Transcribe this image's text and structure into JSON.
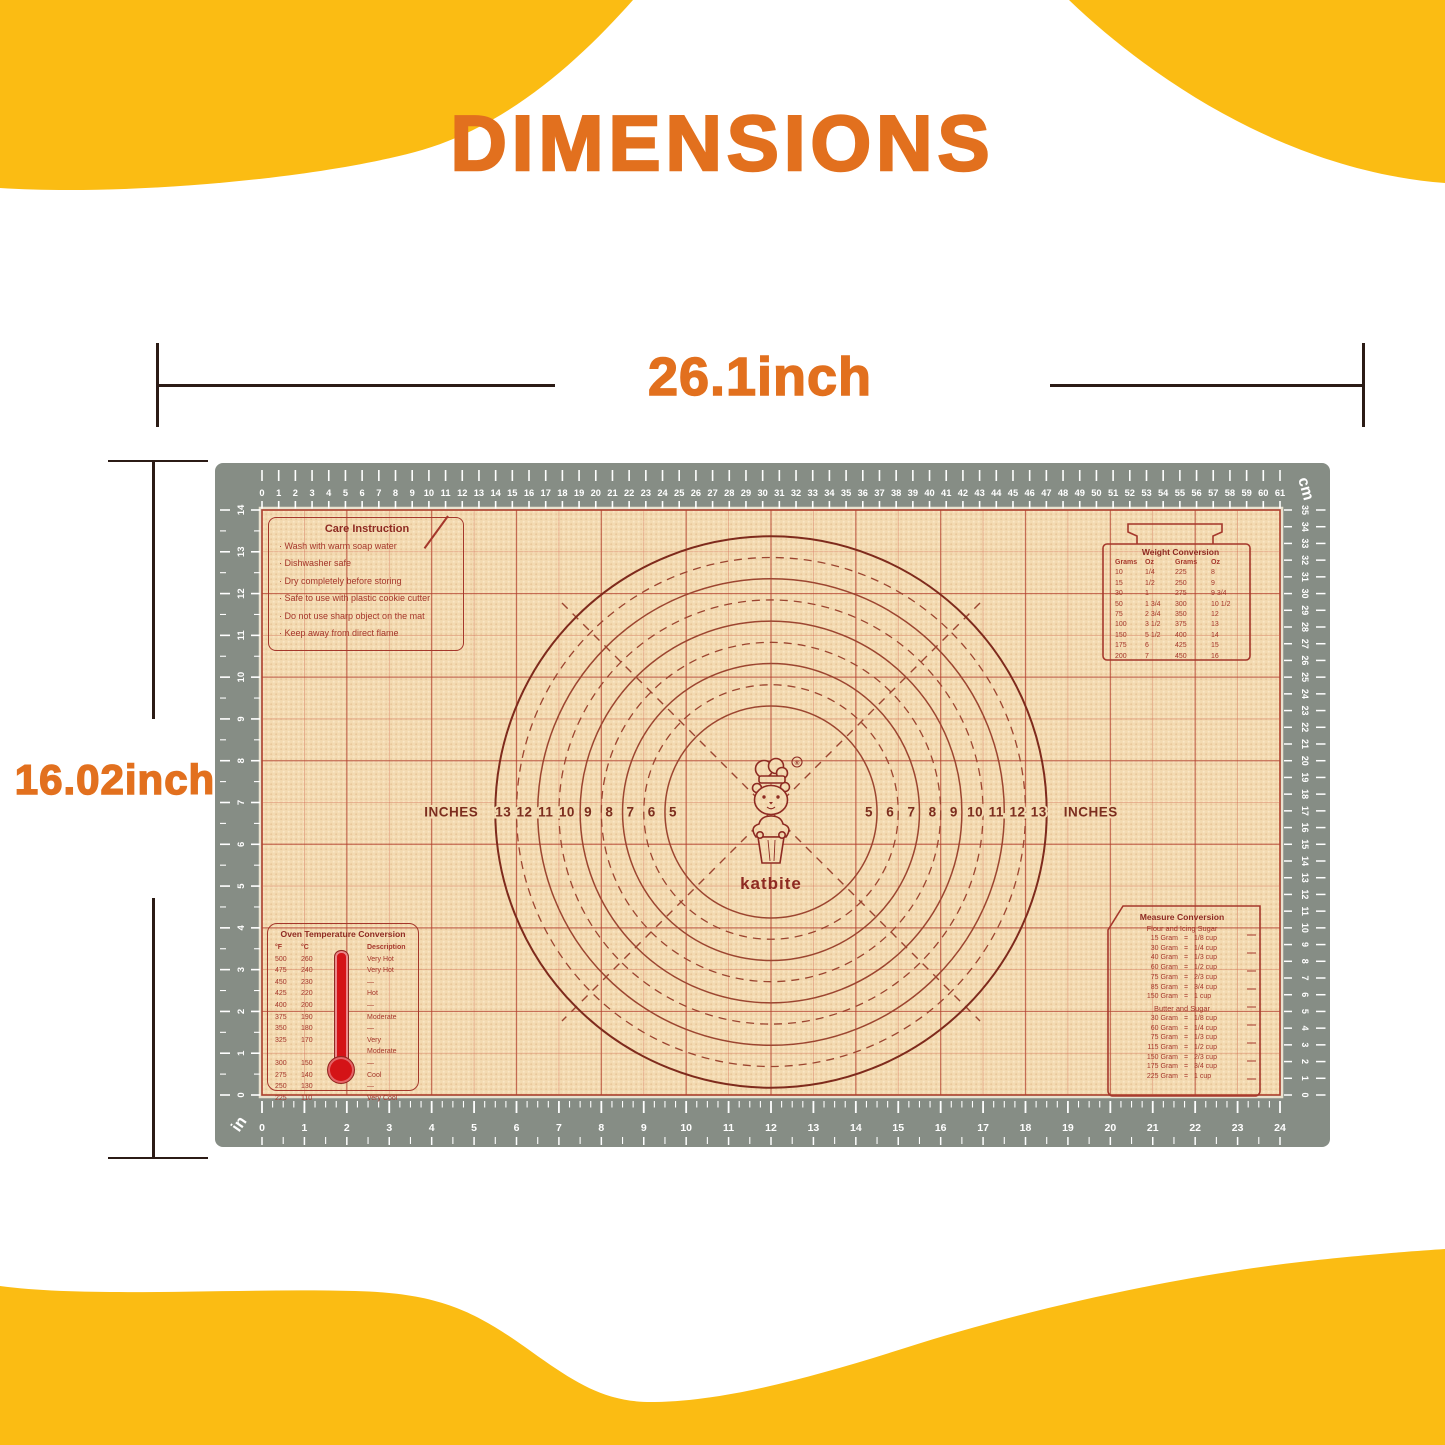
{
  "title": "DIMENSIONS",
  "width_dim": {
    "label": "26.1inch"
  },
  "height_dim": {
    "label": "16.02inch"
  },
  "colors": {
    "banner_yellow": "#FBBC13",
    "title_orange": "#E2701E",
    "dimension_line": "#2B1B15",
    "mat_border_gray": "#868D85",
    "mat_surface_beige": "#F3DAB1",
    "mat_grid_red": "#B23E2D",
    "mat_text_red": "#A5372B",
    "mat_dark_red": "#8E2A22",
    "thermometer_red": "#D41317",
    "ruler_text": "#FFFFFF"
  },
  "mat": {
    "rulers": {
      "top_cm": {
        "unit": "cm",
        "max": 61
      },
      "right_cm": {
        "unit": "cm",
        "max": 35
      },
      "bottom_in": {
        "unit": "in",
        "max": 24
      },
      "left_in": {
        "unit": "in",
        "max": 14
      }
    },
    "circles": {
      "word": "INCHES",
      "sizes_in": [
        5,
        6,
        7,
        8,
        9,
        10,
        11,
        12,
        13
      ],
      "left_labels": [
        "13",
        "12",
        "11",
        "10",
        "9",
        "8",
        "7",
        "6",
        "5"
      ],
      "right_labels": [
        "5",
        "6",
        "7",
        "8",
        "9",
        "10",
        "11",
        "12",
        "13"
      ]
    },
    "logo": {
      "brand": "katbite",
      "reg": "®"
    },
    "care_instruction": {
      "title": "Care Instruction",
      "items": [
        "Wash with warm soap water",
        "Dishwasher safe",
        "Dry completely before storing",
        "Safe to use with plastic cookie cutter",
        "Do not use sharp object on the mat",
        "Keep away from direct flame"
      ]
    },
    "weight_conversion": {
      "title": "Weight Conversion",
      "headers": [
        "Grams",
        "Oz",
        "Grams",
        "Oz"
      ],
      "rows": [
        [
          "10",
          "1/4",
          "225",
          "8"
        ],
        [
          "15",
          "1/2",
          "250",
          "9"
        ],
        [
          "30",
          "1",
          "275",
          "9 3/4"
        ],
        [
          "50",
          "1 3/4",
          "300",
          "10 1/2"
        ],
        [
          "75",
          "2 3/4",
          "350",
          "12"
        ],
        [
          "100",
          "3 1/2",
          "375",
          "13"
        ],
        [
          "150",
          "5 1/2",
          "400",
          "14"
        ],
        [
          "175",
          "6",
          "425",
          "15"
        ],
        [
          "200",
          "7",
          "450",
          "16"
        ]
      ]
    },
    "oven_temperature": {
      "title": "Oven Temperature Conversion",
      "headers": [
        "°F",
        "°C",
        "Description"
      ],
      "rows": [
        [
          "500",
          "260",
          "Very Hot"
        ],
        [
          "475",
          "240",
          "Very Hot"
        ],
        [
          "450",
          "230",
          "—"
        ],
        [
          "425",
          "220",
          "Hot"
        ],
        [
          "400",
          "200",
          "—"
        ],
        [
          "375",
          "190",
          "Moderate"
        ],
        [
          "350",
          "180",
          "—"
        ],
        [
          "325",
          "170",
          "Very Moderate"
        ],
        [
          "300",
          "150",
          "—"
        ],
        [
          "275",
          "140",
          "Cool"
        ],
        [
          "250",
          "130",
          "—"
        ],
        [
          "225",
          "110",
          "Very Cool"
        ]
      ]
    },
    "measure_conversion": {
      "title": "Measure Conversion",
      "sections": [
        {
          "name": "Flour and Icing Sugar",
          "rows": [
            [
              "15 Gram",
              "=",
              "1/8 cup"
            ],
            [
              "30 Gram",
              "=",
              "1/4 cup"
            ],
            [
              "40 Gram",
              "=",
              "1/3 cup"
            ],
            [
              "60 Gram",
              "=",
              "1/2 cup"
            ],
            [
              "75 Gram",
              "=",
              "2/3 cup"
            ],
            [
              "85 Gram",
              "=",
              "3/4 cup"
            ],
            [
              "150 Gram",
              "=",
              "1 cup"
            ]
          ]
        },
        {
          "name": "Butter and Sugar",
          "rows": [
            [
              "30 Gram",
              "=",
              "1/8 cup"
            ],
            [
              "60 Gram",
              "=",
              "1/4 cup"
            ],
            [
              "75 Gram",
              "=",
              "1/3 cup"
            ],
            [
              "115 Gram",
              "=",
              "1/2 cup"
            ],
            [
              "150 Gram",
              "=",
              "2/3 cup"
            ],
            [
              "175 Gram",
              "=",
              "3/4 cup"
            ],
            [
              "225 Gram",
              "=",
              "1 cup"
            ]
          ]
        }
      ]
    }
  }
}
